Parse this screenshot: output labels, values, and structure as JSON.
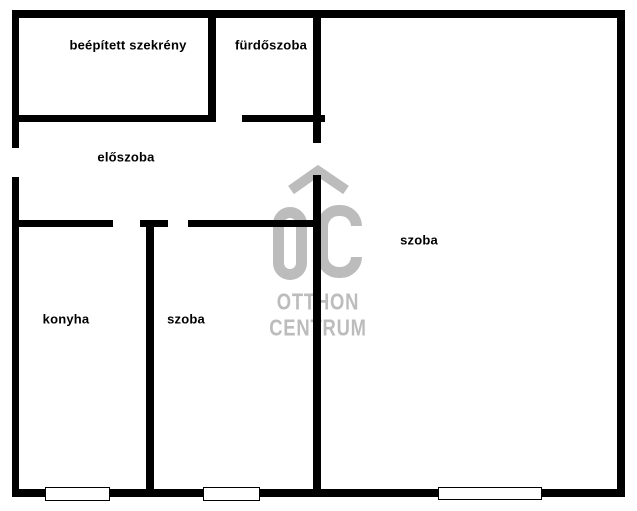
{
  "floorplan": {
    "colors": {
      "background": "#ffffff",
      "wall": "#000000",
      "watermark": "#bcbcbc"
    },
    "rooms": [
      {
        "id": "built-in-closet",
        "label": "beépített szekrény",
        "cx": 128,
        "cy": 45
      },
      {
        "id": "bathroom",
        "label": "fürdőszoba",
        "cx": 271,
        "cy": 45
      },
      {
        "id": "hallway",
        "label": "előszoba",
        "cx": 126,
        "cy": 157
      },
      {
        "id": "kitchen",
        "label": "konyha",
        "cx": 66,
        "cy": 319
      },
      {
        "id": "room-small",
        "label": "szoba",
        "cx": 186,
        "cy": 319
      },
      {
        "id": "room-large",
        "label": "szoba",
        "cx": 419,
        "cy": 240
      }
    ],
    "watermark": {
      "monogram": "OC",
      "line1": "OTTHON",
      "line2": "CENTRUM"
    },
    "walls": [
      {
        "name": "outer-wall-top",
        "x": 12,
        "y": 10,
        "w": 613,
        "h": 8
      },
      {
        "name": "outer-wall-bottom",
        "x": 12,
        "y": 489,
        "w": 613,
        "h": 8
      },
      {
        "name": "outer-wall-left-upper",
        "x": 12,
        "y": 10,
        "w": 7,
        "h": 138
      },
      {
        "name": "outer-wall-left-lower",
        "x": 12,
        "y": 177,
        "w": 7,
        "h": 320
      },
      {
        "name": "outer-wall-right",
        "x": 617,
        "y": 10,
        "w": 8,
        "h": 487
      },
      {
        "name": "closet-bathroom-divider",
        "x": 208,
        "y": 18,
        "w": 8,
        "h": 104
      },
      {
        "name": "closet-bottom-wall",
        "x": 19,
        "y": 115,
        "w": 196,
        "h": 7
      },
      {
        "name": "bathroom-bottom-wall",
        "x": 242,
        "y": 115,
        "w": 83,
        "h": 7
      },
      {
        "name": "center-wall-upper",
        "x": 313,
        "y": 10,
        "w": 8,
        "h": 133
      },
      {
        "name": "center-wall-lower",
        "x": 313,
        "y": 175,
        "w": 8,
        "h": 322
      },
      {
        "name": "hallway-bottom-wall-left",
        "x": 19,
        "y": 220,
        "w": 94,
        "h": 7
      },
      {
        "name": "hallway-bottom-wall-mid",
        "x": 140,
        "y": 220,
        "w": 28,
        "h": 7
      },
      {
        "name": "hallway-bottom-wall-right",
        "x": 188,
        "y": 220,
        "w": 132,
        "h": 7
      },
      {
        "name": "kitchen-room-divider",
        "x": 146,
        "y": 227,
        "w": 8,
        "h": 262
      }
    ],
    "windows": [
      {
        "name": "kitchen-window",
        "x": 45,
        "y": 487,
        "w": 65,
        "h": 14
      },
      {
        "name": "small-room-window",
        "x": 203,
        "y": 487,
        "w": 57,
        "h": 14
      },
      {
        "name": "large-room-window",
        "x": 438,
        "y": 487,
        "w": 104,
        "h": 13
      }
    ]
  }
}
